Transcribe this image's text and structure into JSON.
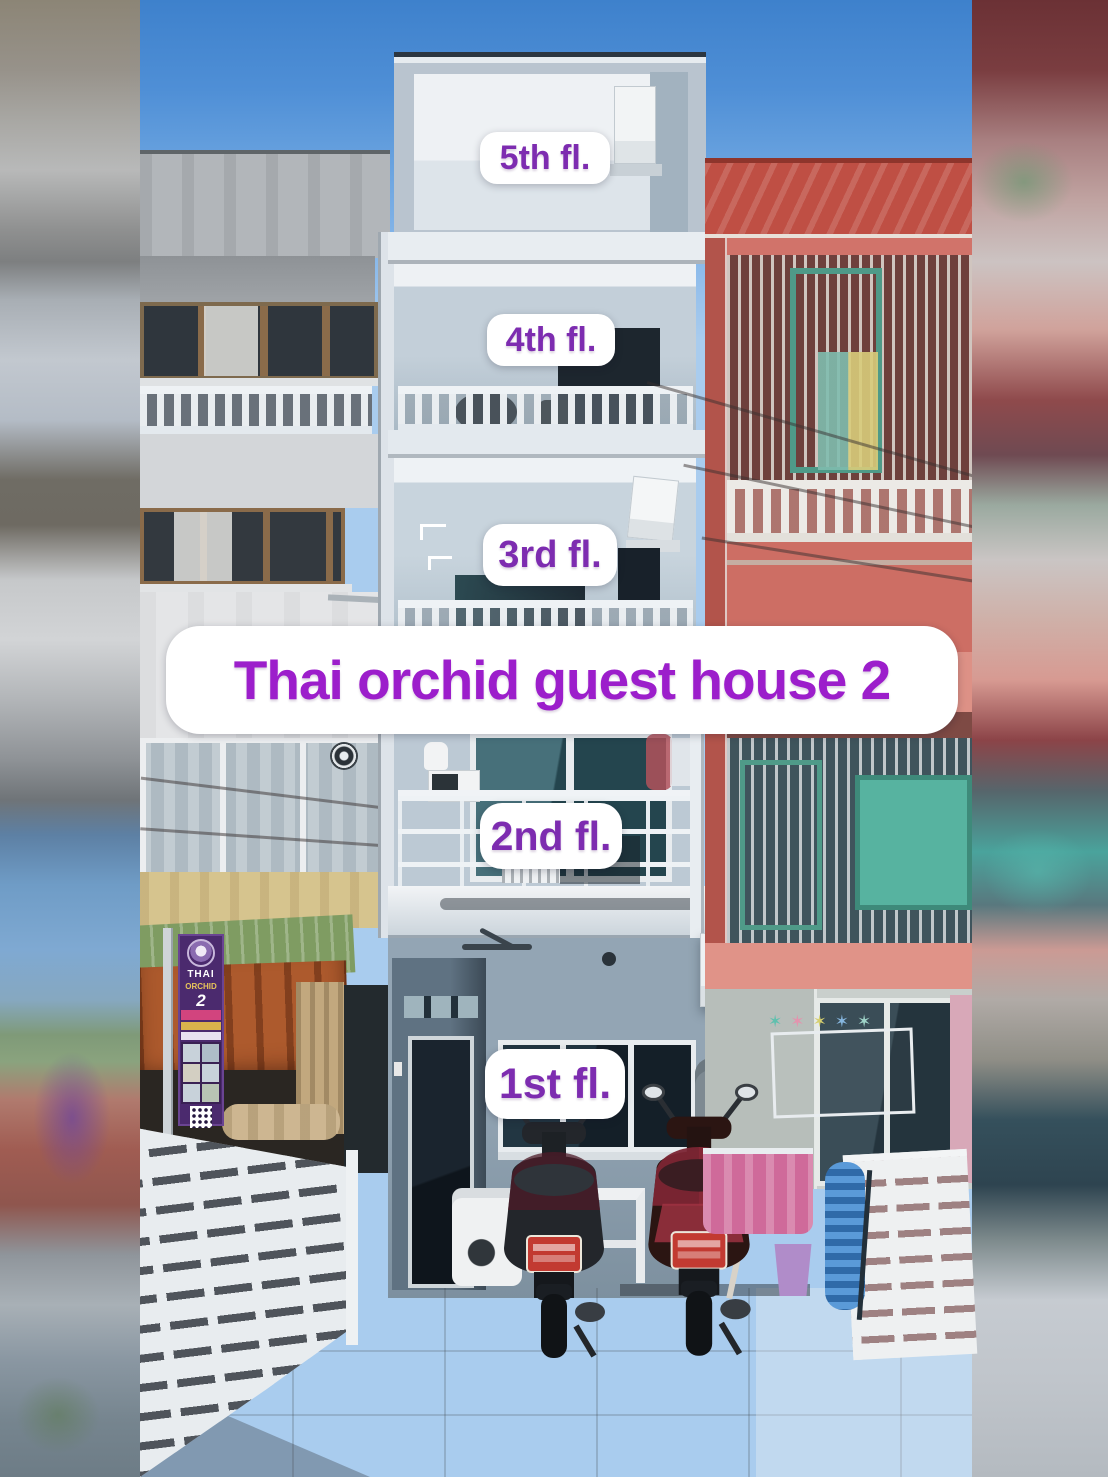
{
  "overlay": {
    "title": "Thai orchid guest house 2",
    "floor_labels": [
      {
        "id": "5",
        "label": "5th fl."
      },
      {
        "id": "4",
        "label": "4th fl."
      },
      {
        "id": "3",
        "label": "3rd fl."
      },
      {
        "id": "2",
        "label": "2nd fl."
      },
      {
        "id": "1",
        "label": "1st fl."
      }
    ],
    "title_color": "#9c1ecb",
    "label_color": "#7d2cb0",
    "sticker_bg": "#ffffff"
  },
  "banner": {
    "name_line1": "THAI",
    "name_line2": "ORCHID",
    "number": "2",
    "bg_color": "#4b2a6e"
  },
  "scene": {
    "colors": {
      "sky": "#4a8ad2",
      "center_building": "#b9c4cf",
      "right_building": "#d1736a",
      "left_building": "#c6c9cc",
      "roof_red": "#bf4f44",
      "awning_green": "#7f9c62",
      "awning_rust": "#ad5a2d",
      "fence_white": "#e8ecef",
      "towel_pink": "#cf6a9a",
      "bucket_purple": "#b08cc9",
      "hose_blue": "#3f7fc1",
      "plate_red": "#c23a31"
    }
  }
}
